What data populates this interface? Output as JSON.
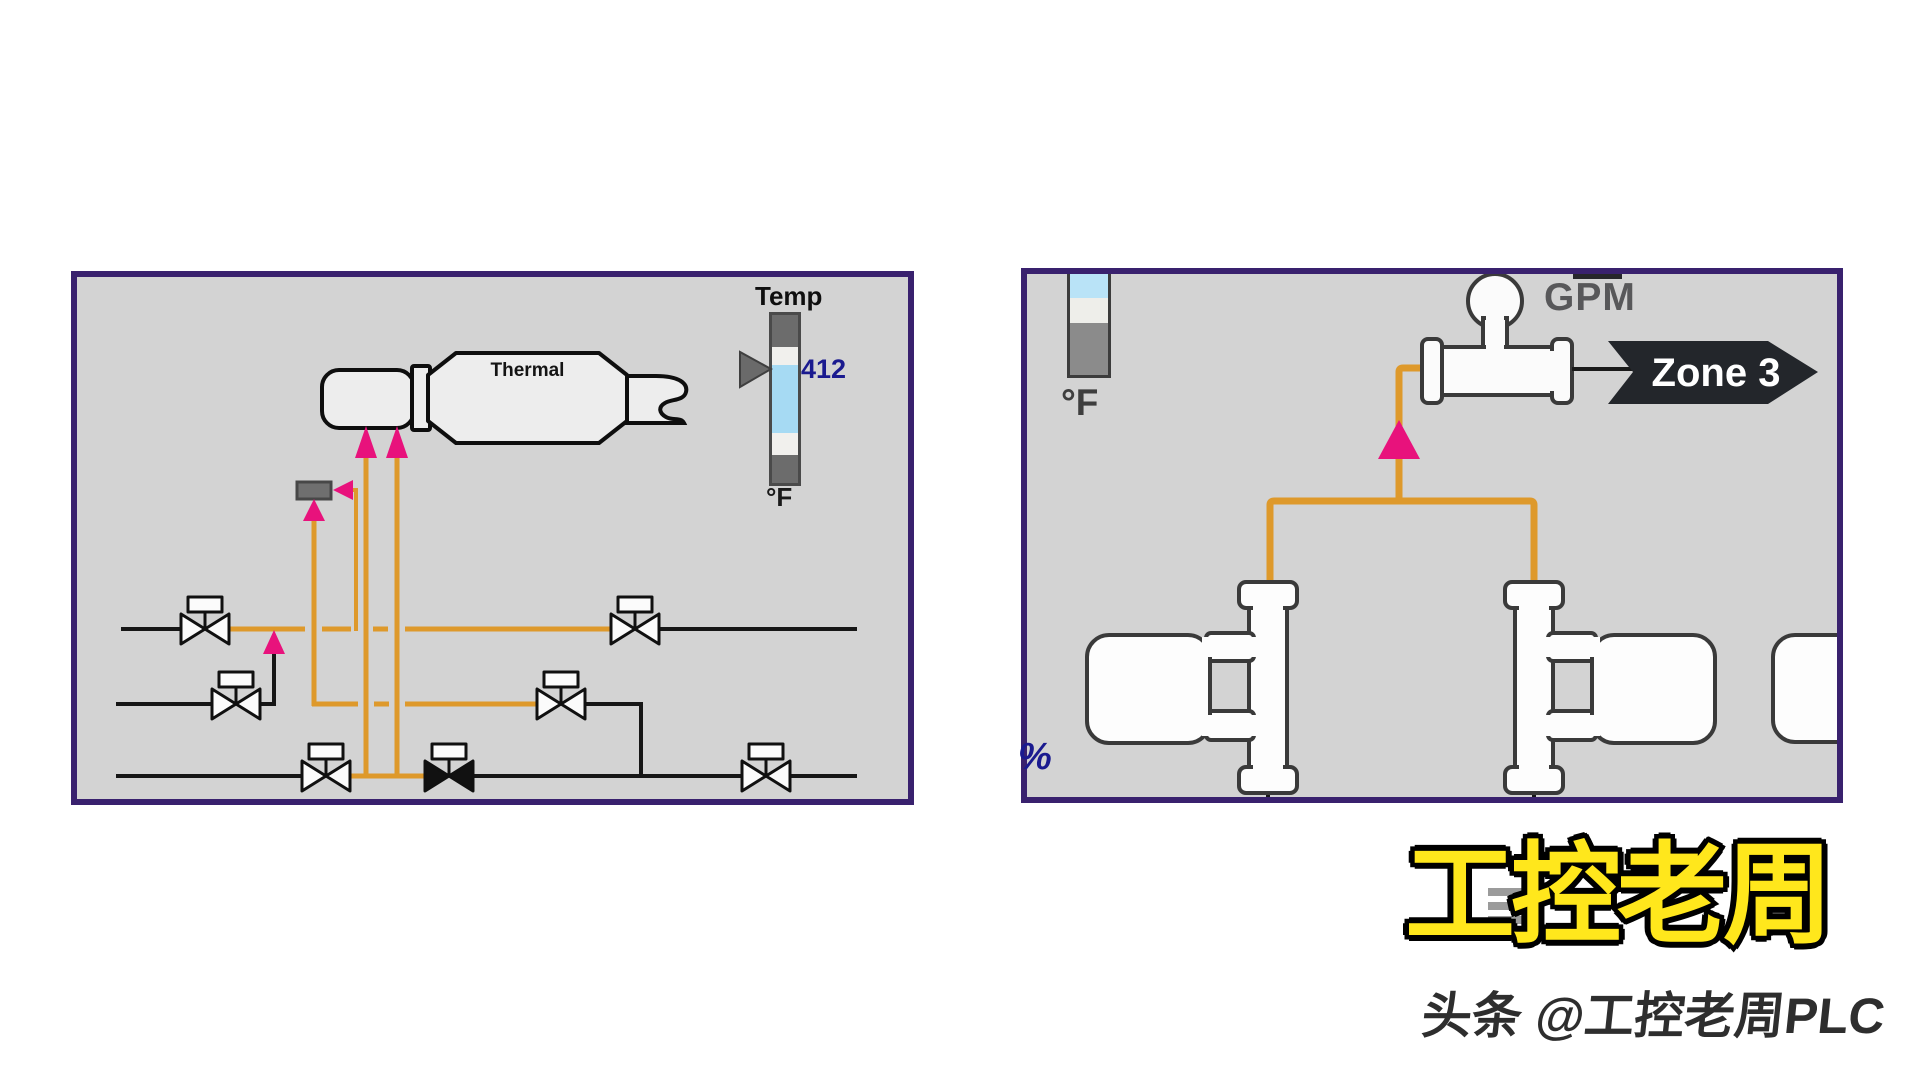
{
  "left_panel": {
    "vessel_label": "Thermal",
    "temp_indicator": {
      "label": "Temp",
      "value": "412",
      "unit": "°F"
    },
    "valves": [
      {
        "id": "valve-row1-left",
        "state": "open"
      },
      {
        "id": "valve-row2-left",
        "state": "open"
      },
      {
        "id": "valve-row3-left",
        "state": "open"
      },
      {
        "id": "valve-row3-center",
        "state": "closed"
      },
      {
        "id": "valve-row1-right",
        "state": "open"
      },
      {
        "id": "valve-row2-right",
        "state": "open"
      },
      {
        "id": "valve-row3-right",
        "state": "open"
      }
    ]
  },
  "right_panel": {
    "temp_bar": {
      "unit": "°F"
    },
    "flow_meter": {
      "label": "GPM"
    },
    "zone_banner": {
      "label": "Zone 3"
    },
    "percent_label": "%"
  },
  "watermark": {
    "title": "工控老周",
    "subtitle": "头条 @工控老周PLC"
  },
  "colors": {
    "panel_border": "#39216E",
    "panel_bg": "#D3D3D3",
    "pipe_orange": "#DE992B",
    "arrow_pink": "#E8127C",
    "value_navy": "#1A1A8F",
    "level_blue": "#A6DAF3",
    "banner_black": "#23262B",
    "watermark_yellow": "#FFE71C"
  }
}
